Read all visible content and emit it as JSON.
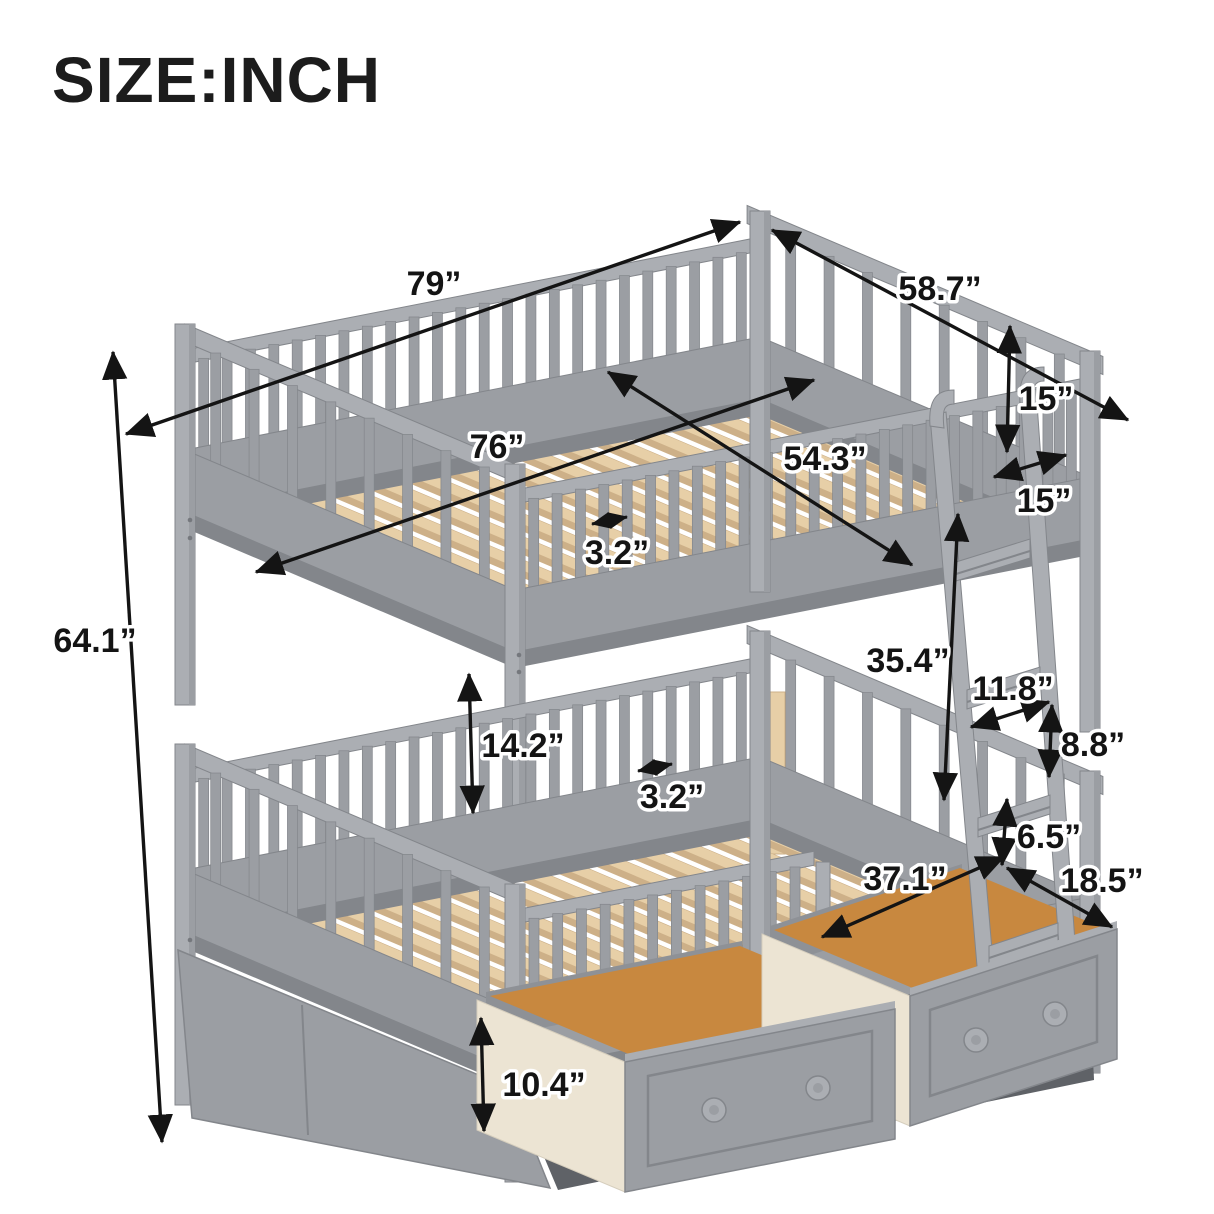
{
  "title": "SIZE:INCH",
  "dimensions": {
    "overall_length": "79”",
    "overall_depth": "58.7”",
    "slat_area_length": "76”",
    "slat_area_width": "54.3”",
    "upper_slat_gap": "3.2”",
    "upper_guardrail_height": "15”",
    "ladder_depth": "15”",
    "overall_height": "64.1”",
    "bunk_clearance": "35.4”",
    "ladder_rung_length": "11.8”",
    "ladder_rung_spacing": "8.8”",
    "lower_guardrail_height": "14.2”",
    "lower_slat_gap": "3.2”",
    "drawer_inner_depth": "6.5”",
    "drawer_length": "37.1”",
    "drawer_width": "18.5”",
    "drawer_front_height": "10.4”"
  },
  "colors": {
    "background": "#ffffff",
    "frame_gray_light": "#abaeb3",
    "frame_gray": "#9b9ea3",
    "frame_gray_dark": "#83868b",
    "cavity_shadow": "#5f6267",
    "slat_wood": "#e7cfa7",
    "slat_wood_dark": "#cdb088",
    "drawer_interior_wood": "#c8883f",
    "drawer_side_cream": "#ece4d3",
    "annotation": "#141414"
  }
}
